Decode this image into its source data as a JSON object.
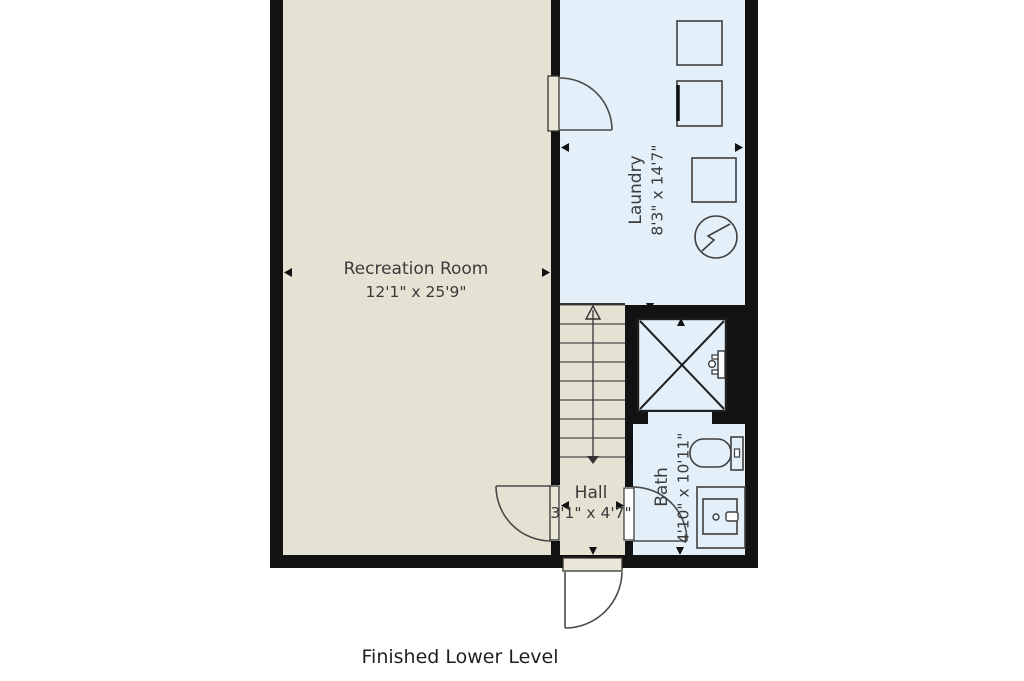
{
  "title": "Finished Lower Level",
  "colors": {
    "wall": "#121212",
    "floor_main": "#e6e2d3",
    "floor_wet": "#e3f0fa",
    "door_slab": "#eae6d8",
    "text": "#3b3b3b"
  },
  "rooms": {
    "recreation": {
      "name": "Recreation Room",
      "dims": "12'1\" x 25'9\""
    },
    "laundry": {
      "name": "Laundry",
      "dims": "8'3\" x 14'7\""
    },
    "hall": {
      "name": "Hall",
      "dims": "3'1\" x 4'7\""
    },
    "bath": {
      "name": "Bath",
      "dims": "4'10\" x 10'11\""
    }
  },
  "fixtures": [
    "washer",
    "dryer",
    "utility-appliance",
    "water-heater",
    "shower",
    "shower-valve",
    "toilet",
    "sink-vanity",
    "stairs",
    "door-laundry",
    "door-hall",
    "door-bath",
    "door-exterior"
  ]
}
